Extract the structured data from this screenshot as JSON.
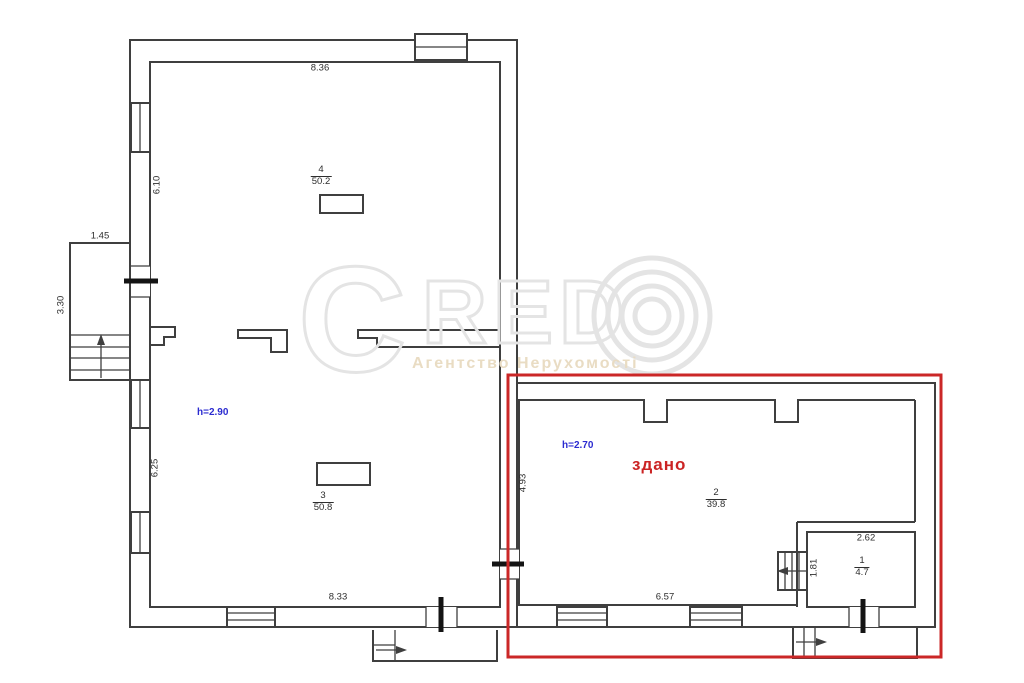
{
  "title": "floor-plan",
  "colors": {
    "wall_line": "#3f3f3f",
    "door_line": "#141414",
    "highlight_red": "#cb2727",
    "height_blue": "#2b2bd0",
    "dimension_text": "#2e2e2e",
    "watermark_gray": "#e4e4e4",
    "watermark_subtitle": "#e9dcc3"
  },
  "status_label": "здано",
  "watermark": {
    "letter_c": "C",
    "letters": "RED",
    "subtitle": "Агентство Нерухомості"
  },
  "rooms": [
    {
      "number": "4",
      "area": "50.2",
      "height": "h=2.90"
    },
    {
      "number": "3",
      "area": "50.8"
    },
    {
      "number": "2",
      "area": "39.8",
      "height": "h=2.70"
    },
    {
      "number": "1",
      "area": "4.7"
    }
  ],
  "dimensions": {
    "top_width": "8.36",
    "left_upper_height": "6.10",
    "stair_width": "1.45",
    "stair_height": "3.30",
    "left_lower_height": "6.25",
    "bottom_width_left": "8.33",
    "annex_left_height": "4.93",
    "annex_bottom_width": "6.57",
    "room1_width": "2.62",
    "room1_height": "1.81"
  }
}
